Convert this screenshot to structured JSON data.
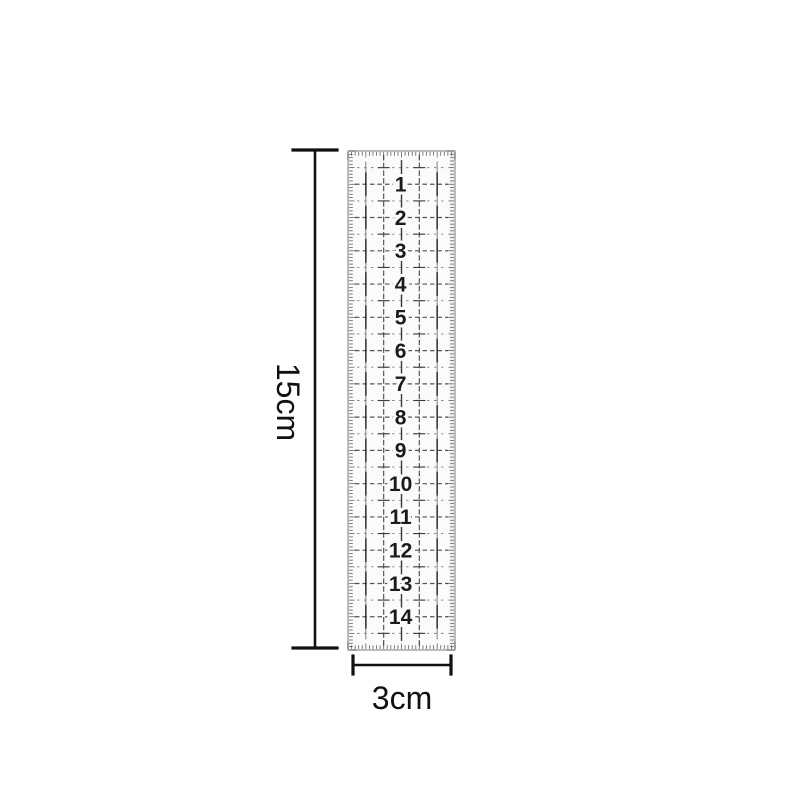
{
  "background_color": "#ffffff",
  "ruler": {
    "numbers": [
      1,
      2,
      3,
      4,
      5,
      6,
      7,
      8,
      9,
      10,
      11,
      12,
      13,
      14
    ],
    "body_color": "#fbfbfa",
    "print_color": "#3a3a3a",
    "halfline_color": "#555555",
    "number_color": "#1b1b1b",
    "border_color": "#8f8f8f"
  },
  "annotations": {
    "length_label": "15cm",
    "width_label": "3cm",
    "line_color": "#111111",
    "text_color": "#111111"
  }
}
